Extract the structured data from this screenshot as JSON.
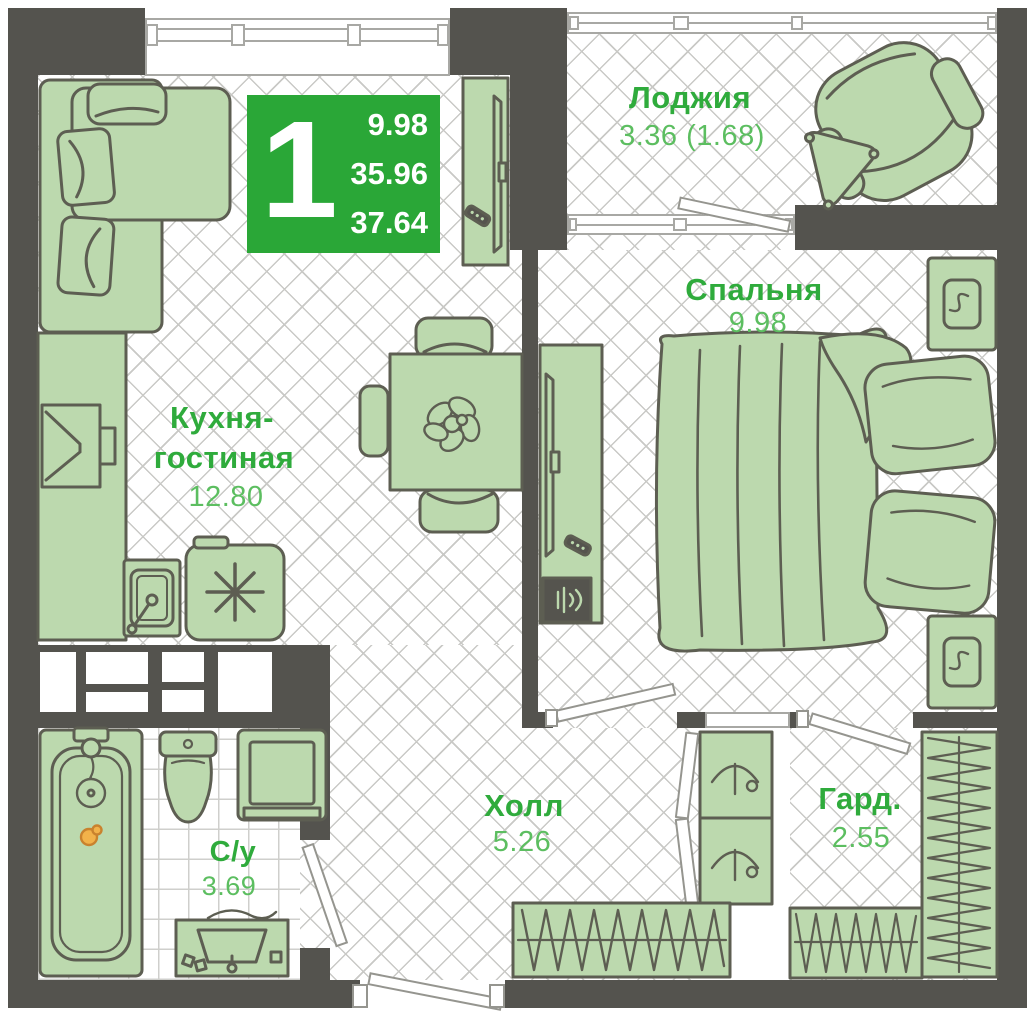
{
  "colors": {
    "badge_green": "#2AA737",
    "label_green": "#2FAB3C",
    "area_green": "#5CBE60",
    "wall": "#54534E",
    "furn_fill": "#BCD9AE",
    "furn_line": "#5D5E52",
    "duck_accent": "#F2B24A"
  },
  "badge": {
    "room_count": "1",
    "areas": [
      "9.98",
      "35.96",
      "37.64"
    ]
  },
  "rooms": {
    "loggia": {
      "name": "Лоджия",
      "area": "3.36 (1.68)"
    },
    "bedroom": {
      "name": "Спальня",
      "area": "9.98"
    },
    "kitchen_living": {
      "name_line1": "Кухня-",
      "name_line2": "гостиная",
      "area": "12.80"
    },
    "hall": {
      "name": "Холл",
      "area": "5.26"
    },
    "bathroom": {
      "name": "С/у",
      "area": "3.69"
    },
    "wardrobe": {
      "name": "Гард.",
      "area": "2.55"
    }
  },
  "furniture": [
    "corner-sofa",
    "tv-console",
    "kitchen-counter",
    "kitchen-sink",
    "stove",
    "dining-table",
    "dining-chairs",
    "houseplant",
    "double-bed",
    "nightstands",
    "tv-dresser",
    "speaker",
    "remote-control",
    "armchair",
    "side-table",
    "bathtub",
    "rubber-duck",
    "toilet",
    "washing-machine",
    "vanity-sink",
    "coat-closet",
    "closet-hangers",
    "wardrobe-racks"
  ]
}
